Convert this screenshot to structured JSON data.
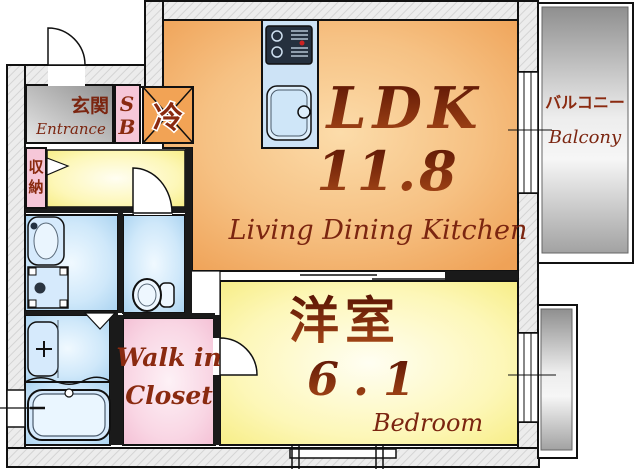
{
  "floorplan": {
    "title": "1LDK apartment floor plan",
    "rooms": {
      "ldk": {
        "abbr": "LDK",
        "size": "11.8",
        "subtitle": "Living Dining Kitchen"
      },
      "bedroom": {
        "name": "洋室",
        "size": "6.1",
        "subtitle": "Bedroom"
      },
      "balcony": {
        "name": "バルコニー",
        "subtitle": "Balcony"
      },
      "entrance": {
        "name": "玄関",
        "subtitle": "Entrance"
      },
      "shoebox": {
        "s": "S",
        "b": "B"
      },
      "fridge": {
        "label": "冷"
      },
      "storage": {
        "c1": "収",
        "c2": "納"
      },
      "wic": {
        "line1": "Walk in",
        "line2": "Closet"
      }
    },
    "colors": {
      "label_text": "#7b2510",
      "wall_fill": "#ececec",
      "ldk_orange": "#efa257",
      "room_yellow": "#f6ec7e",
      "wet_area_blue": "#a5d0ef",
      "closet_pink": "#f3bcd2",
      "balcony_gray": "#9c9c9c",
      "entrance_gray": "#8f8f8f"
    },
    "fixtures": [
      "kitchen-counter",
      "stove",
      "kitchen-sink",
      "refrigerator",
      "corner-basin",
      "washing-machine-pan",
      "toilet",
      "vanity-sink",
      "bathtub"
    ]
  }
}
